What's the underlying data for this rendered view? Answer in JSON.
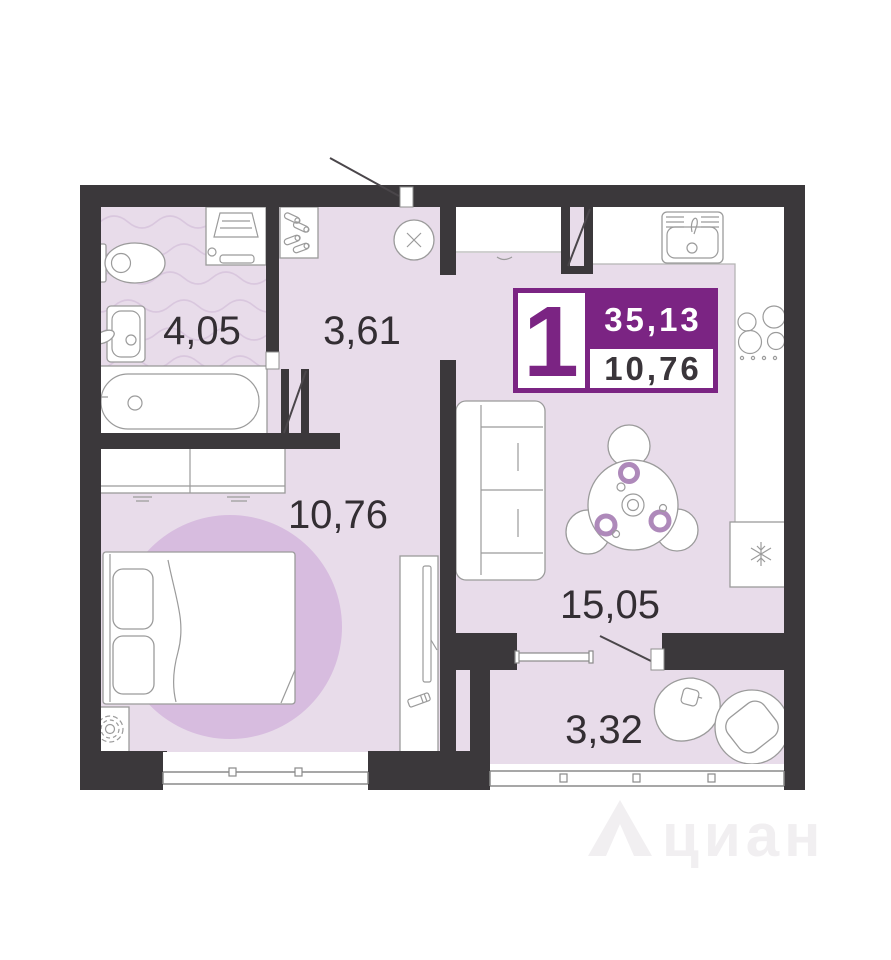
{
  "plan": {
    "badge": {
      "rooms_count": "1",
      "total_area": "35,13",
      "living_area": "10,76"
    },
    "rooms": [
      {
        "id": "bathroom",
        "area": "4,05"
      },
      {
        "id": "hallway",
        "area": "3,61"
      },
      {
        "id": "bedroom",
        "area": "10,76"
      },
      {
        "id": "kitchen-living",
        "area": "15,05"
      },
      {
        "id": "balcony",
        "area": "3,32"
      }
    ],
    "watermark": "циан",
    "colors": {
      "wall": "#3b383b",
      "floor": "#e8dcea",
      "wave": "#d9c7de",
      "rug": "#d7bcdf",
      "accent": "#7b2483",
      "accent2": "#ae89ba",
      "label": "#332e33",
      "outline": "#9b9b9b",
      "watermark": "#f1eff1"
    }
  }
}
